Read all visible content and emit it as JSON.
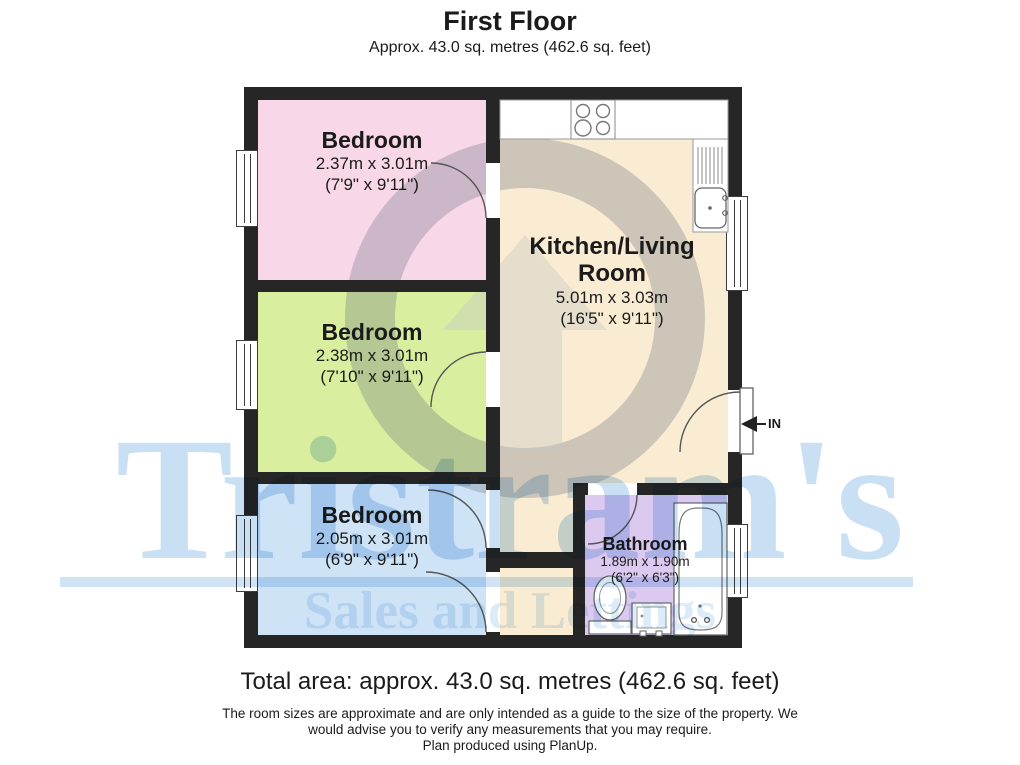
{
  "header": {
    "title": "First Floor",
    "subtitle": "Approx. 43.0 sq. metres (462.6 sq. feet)"
  },
  "rooms": [
    {
      "name": "Bedroom",
      "dim_metric": "2.37m x 3.01m",
      "dim_imperial": "(7'9\" x 9'11\")",
      "color": "#f8d7e8"
    },
    {
      "name": "Bedroom",
      "dim_metric": "2.38m x 3.01m",
      "dim_imperial": "(7'10\" x 9'11\")",
      "color": "#d9ee9e"
    },
    {
      "name": "Bedroom",
      "dim_metric": "2.05m x 3.01m",
      "dim_imperial": "(6'9\" x 9'11\")",
      "color": "#cfe3f6"
    },
    {
      "name_lines": [
        "Kitchen/Living",
        "Room"
      ],
      "dim_metric": "5.01m x 3.03m",
      "dim_imperial": "(16'5\" x 9'11\")",
      "color": "#faecd2"
    },
    {
      "name": "Bathroom",
      "dim_metric": "1.89m x 1.90m",
      "dim_imperial": "(6'2\" x 6'3\")",
      "color": "#dcc9f0"
    }
  ],
  "entry_label": "IN",
  "watermark": {
    "name": "Tristram's",
    "tagline": "Sales and Lettings",
    "name_color": "#c8dff4",
    "tagline_color": "#dcebf8"
  },
  "footer": {
    "total": "Total area: approx. 43.0 sq. metres (462.6 sq. feet)",
    "disclaimer_line1": "The room sizes are approximate and are only intended as a guide to the size of the property. We",
    "disclaimer_line2": "would advise you to verify any measurements that you may require.",
    "produced": "Plan produced using PlanUp."
  },
  "colors": {
    "wall": "#262626",
    "fixture_stroke": "#666666",
    "text": "#1b1b1b"
  }
}
